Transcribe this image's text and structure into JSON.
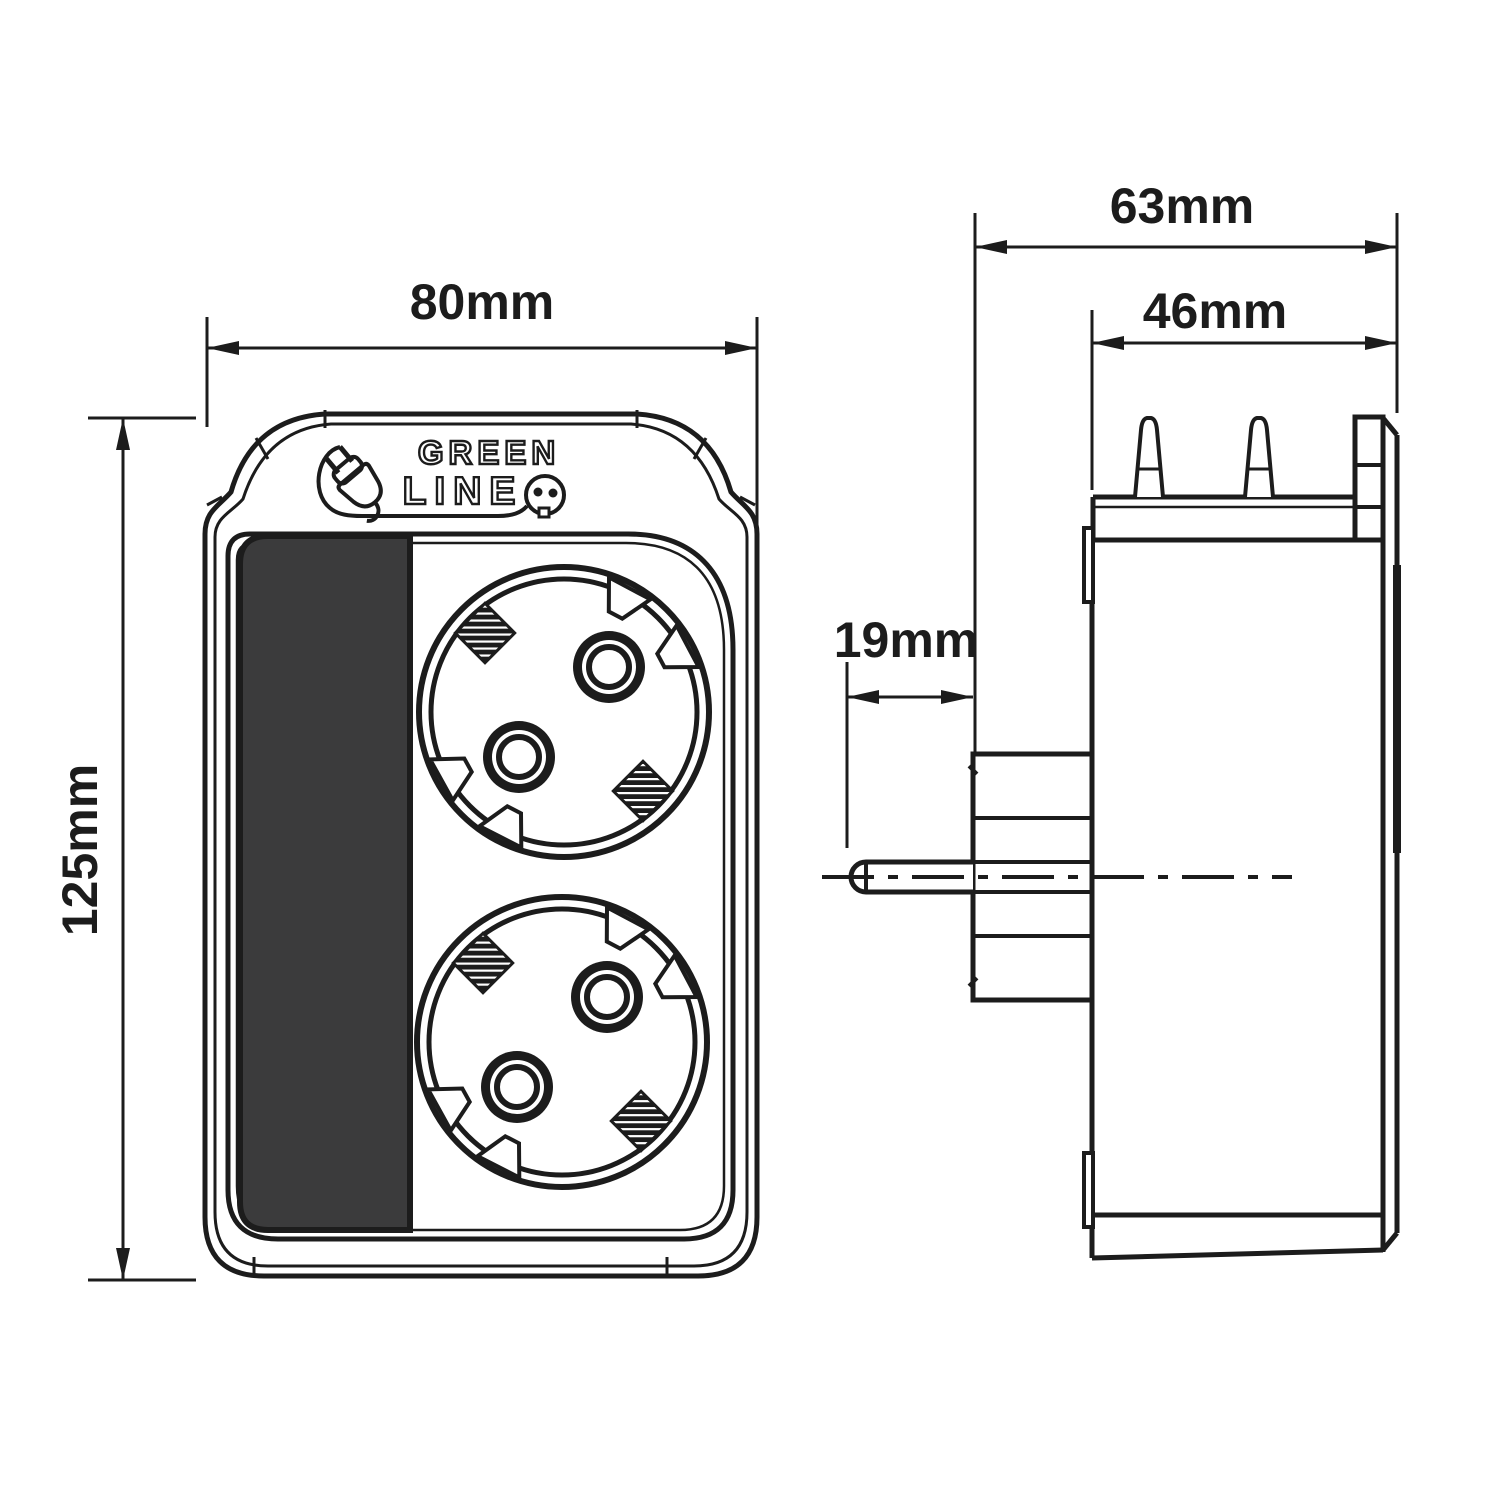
{
  "colors": {
    "line": "#1c1c1c",
    "panel_fill": "#3b3b3c",
    "paper": "#ffffff"
  },
  "logo": {
    "word1": "GREEN",
    "word2": "LINE",
    "icons": [
      "plug-icon",
      "socket-face-icon"
    ]
  },
  "dimensions": {
    "front_width": {
      "value": "80mm"
    },
    "front_height": {
      "value": "125mm"
    },
    "side_depth_total": {
      "value": "63mm"
    },
    "side_depth_body": {
      "value": "46mm"
    },
    "pin_length": {
      "value": "19mm"
    }
  },
  "views": {
    "front": {
      "sockets_count": 2
    },
    "side": {
      "pins_top_count": 2
    }
  }
}
